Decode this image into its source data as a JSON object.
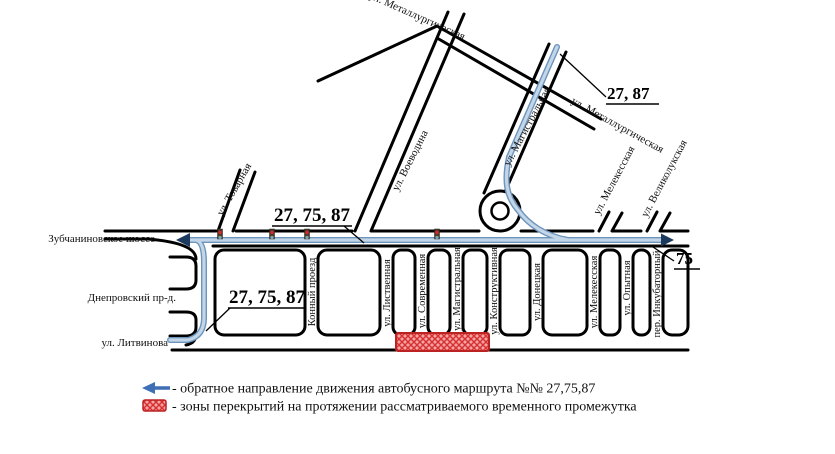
{
  "map_title": "Схема движения автобусных маршрутов (Зубчаниновка)",
  "colors": {
    "road": "#000000",
    "route_blue_light": "#c3d6e8",
    "route_blue_dark": "#6d94bd",
    "closure_red": "#e23b3b",
    "closure_red_border": "#bb2222",
    "legend_arrow_blue": "#3f6fb5"
  },
  "routes": {
    "junction_label": "27, 75, 87",
    "west_label": "27, 75, 87",
    "north_label": "27, 87",
    "east_label": "75"
  },
  "streets": {
    "shosse": "Зубчаниновское шоссе",
    "dneprovsky": "Днепровский пр-д.",
    "litvinova": "ул. Литвинова",
    "tovarnaya": "ул. Товарная",
    "voevodina": "ул. Воеводина",
    "metallurgicheskaya_top": "ул. Металлургическая",
    "metallurgicheskaya_right": "ул. Металлургическая",
    "magistralnaya_diag": "ул. Магистральная",
    "melekesskaya_north": "ул. Мелекесская",
    "velikolukskaya": "ул. Великолукская",
    "konny_proezd": "Конный проезд",
    "listvennaya": "ул. Лиственная",
    "sovremennaya": "ул. Современная",
    "magistralnaya_south": "ул. Магистральная",
    "konstruktivnaya": "ул. Конструктивная",
    "donetskaya": "ул. Донецкая",
    "melekesskaya_south": "ул. Мелекесская",
    "opytnaya": "ул. Опытная",
    "inkubatorny": "пер. Инкубаторный"
  },
  "legend": {
    "reverse_direction_label": "- обратное направление движения  автобусного маршрута №№ 27,75,87",
    "closure_zone_label": "- зоны перекрытий на протяжении рассматриваемого временного промежутка"
  }
}
